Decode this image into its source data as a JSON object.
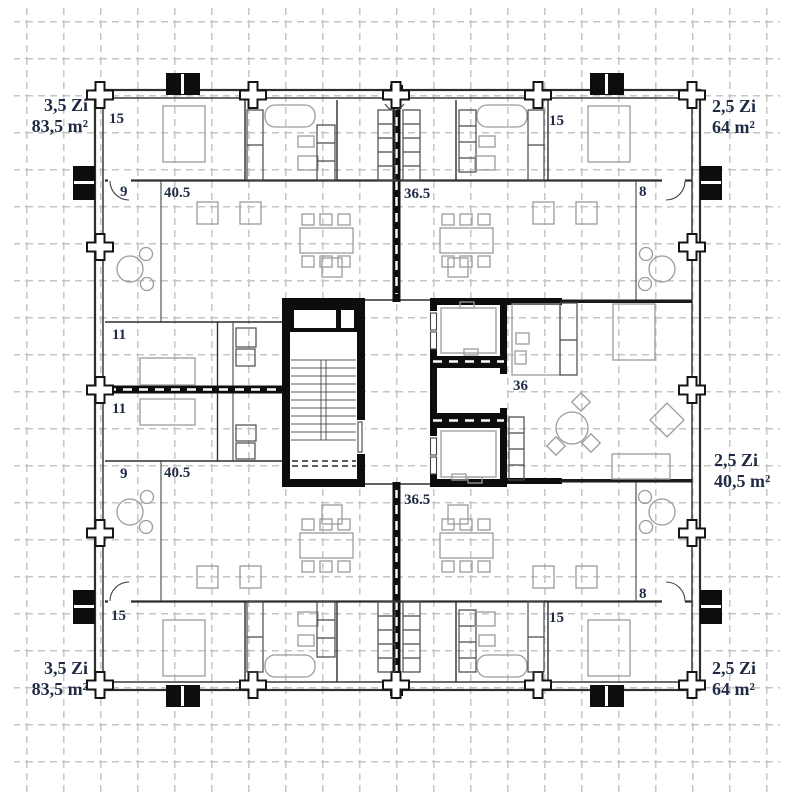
{
  "drawing": {
    "type": "apartment-floor-plan",
    "units": [
      {
        "id": "top-left",
        "rooms": "3,5 Zi",
        "area": "83,5 m²"
      },
      {
        "id": "top-right",
        "rooms": "2,5 Zi",
        "area": "64 m²"
      },
      {
        "id": "middle-right",
        "rooms": "2,5 Zi",
        "area": "40,5 m²"
      },
      {
        "id": "bottom-left",
        "rooms": "3,5 Zi",
        "area": "83,5 m²"
      },
      {
        "id": "bottom-right",
        "rooms": "2,5 Zi",
        "area": "64 m²"
      }
    ],
    "dimensions": {
      "tl_15": "15",
      "tr_15": "15",
      "bl_15": "15",
      "br_15": "15",
      "tl_9": "9",
      "bl_9": "9",
      "tl_405": "40.5",
      "bl_405": "40.5",
      "top_365": "36.5",
      "bottom_365": "36.5",
      "room_11_upper": "11",
      "room_11_lower": "11",
      "tr_8": "8",
      "br_8": "8",
      "elevator_36": "36"
    },
    "colors": {
      "background": "#ffffff",
      "grid": "#c6c6c6",
      "wall": "#2e2e2e",
      "core_wall": "#0d0d0d",
      "furniture": "#9b9b9b",
      "label_text": "#1f2a44"
    }
  }
}
